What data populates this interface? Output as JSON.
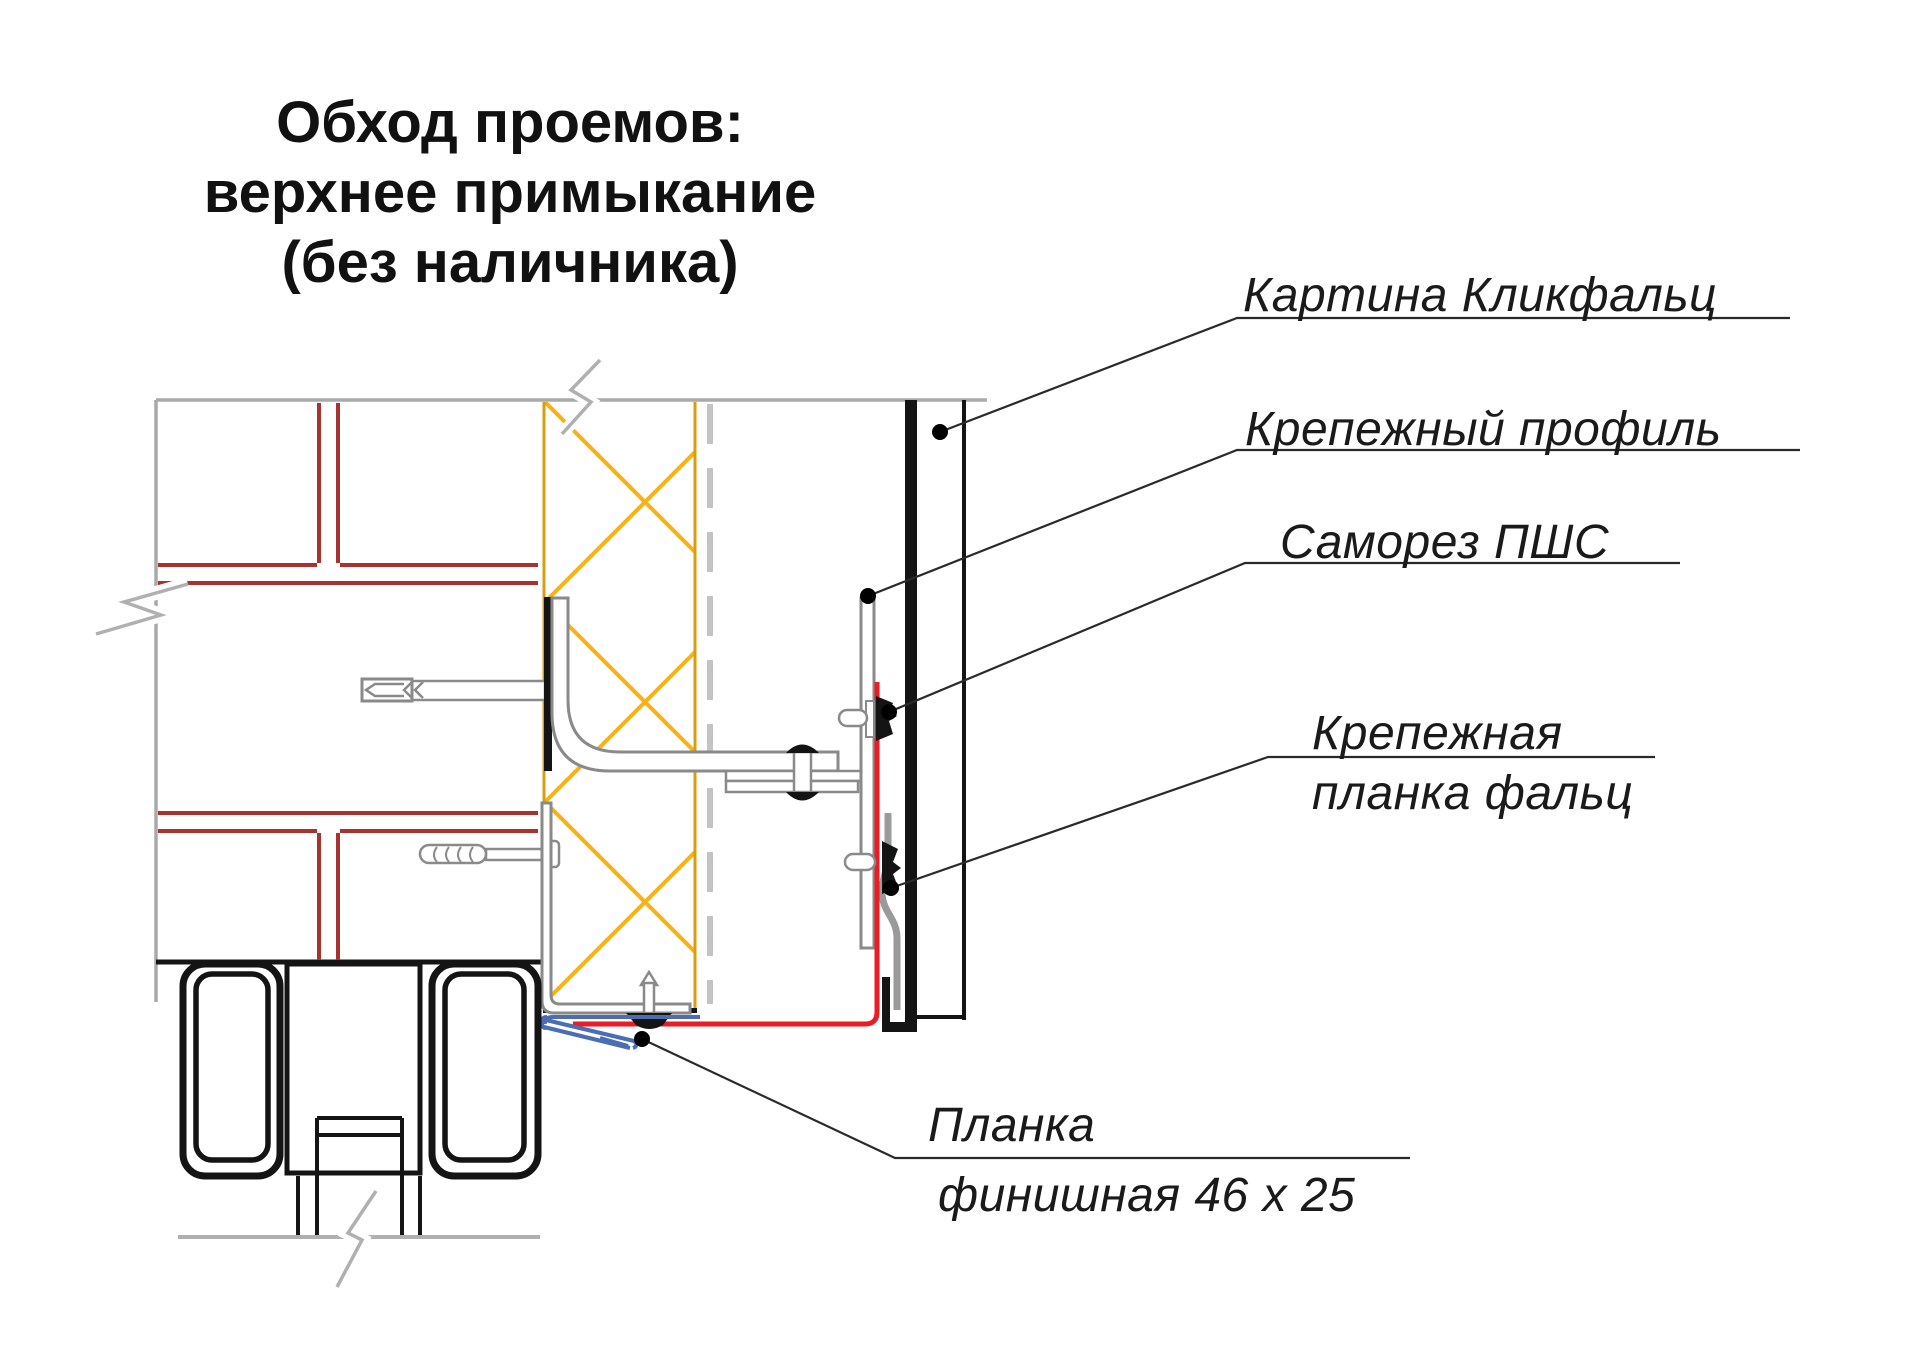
{
  "title": {
    "line1": "Обход проемов:",
    "line2": "верхнее примыкание",
    "line3": "(без наличника)"
  },
  "callouts": {
    "panel": "Картина Кликфальц",
    "profile": "Крепежный профиль",
    "screw": "Саморез ПШС",
    "falz_line1": "Крепежная",
    "falz_line2": "планка фальц",
    "finish_line1": "Планка",
    "finish_line2": "финишная 46 х 25"
  },
  "colors": {
    "brick_joint": "#a53430",
    "insulation": "#f6b216",
    "insulation_border": "#d99e0e",
    "membrane": "#c4c4c4",
    "outline_gray": "#a9a9a9",
    "metal": "#8a8a8a",
    "flashing_red": "#ed1b24",
    "finish_blue": "#4a6db4",
    "ink": "#141414",
    "leader": "#2a2a2a"
  }
}
